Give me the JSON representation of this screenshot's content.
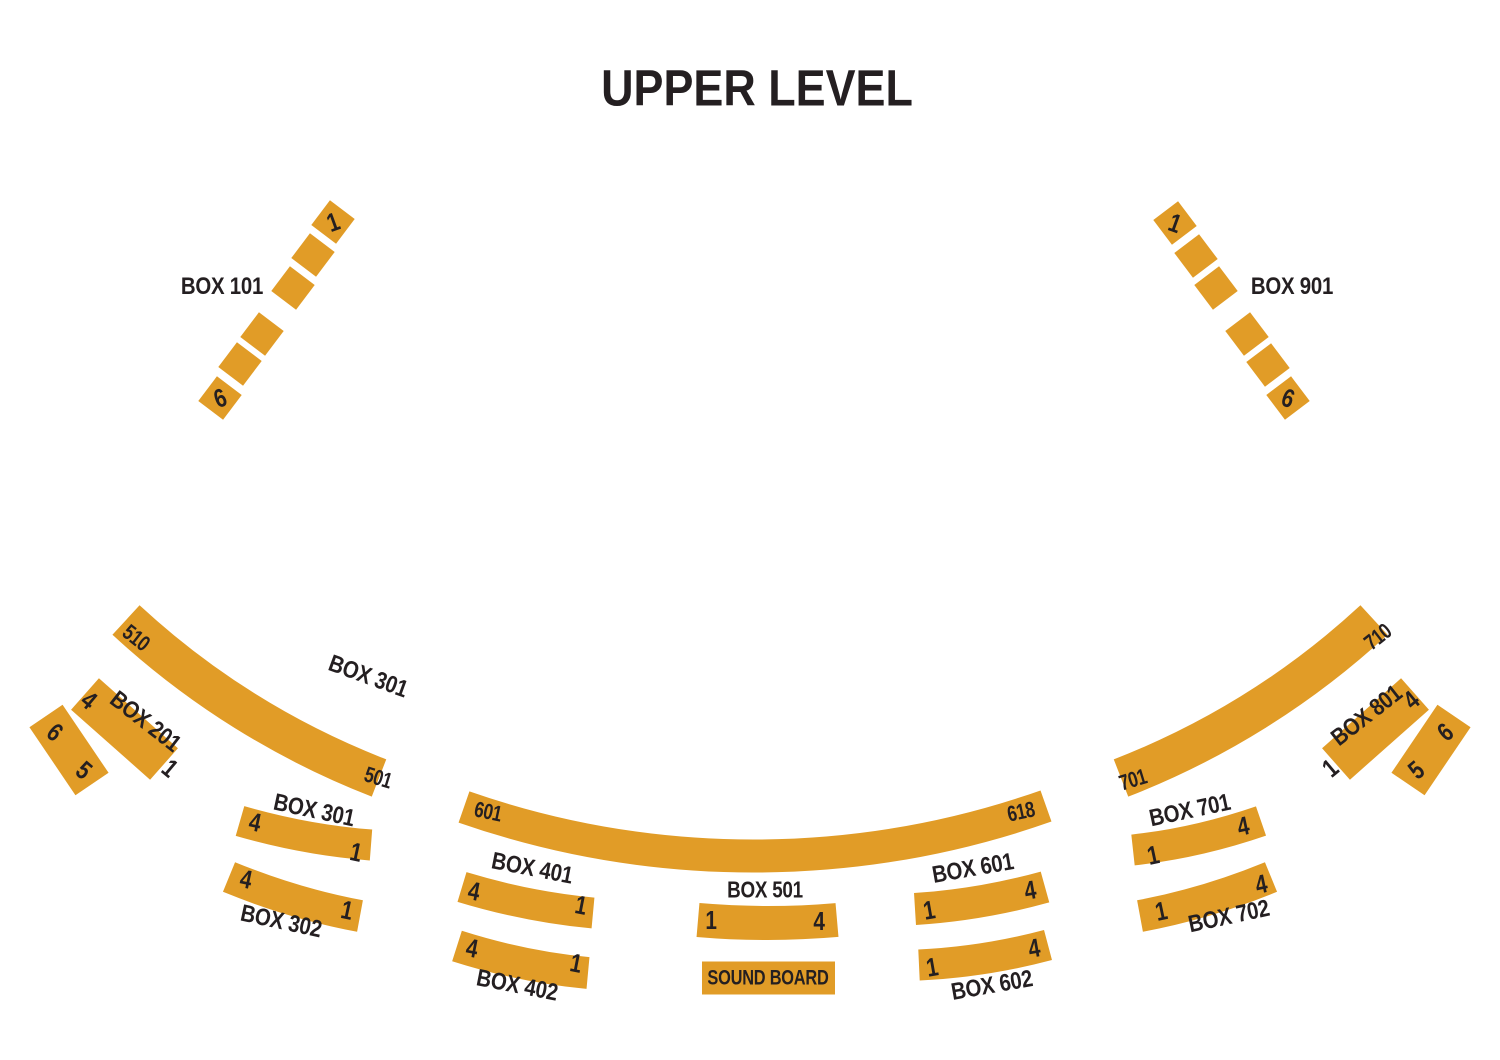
{
  "title": "UPPER LEVEL",
  "colors": {
    "seat_gold": "#E19C27",
    "text_ink": "#241F21",
    "background": "#FFFFFF"
  },
  "soundboard_label": "SOUND BOARD",
  "boxes": {
    "box101": {
      "label": "BOX 101",
      "seat_first": "1",
      "seat_last": "6"
    },
    "box901": {
      "label": "BOX 901",
      "seat_first": "1",
      "seat_last": "6"
    },
    "box201": {
      "label": "BOX 201",
      "seat1": "1",
      "seat4": "4",
      "seat5": "5",
      "seat6": "6"
    },
    "box801": {
      "label": "BOX 801",
      "seat1": "1",
      "seat4": "4",
      "seat5": "5",
      "seat6": "6"
    },
    "row500": {
      "label": "BOX 301",
      "seat_first": "501",
      "seat_last": "510"
    },
    "row600": {
      "seat_first": "601",
      "seat_last": "618"
    },
    "row700": {
      "seat_first": "701",
      "seat_last": "710"
    },
    "box301": {
      "label": "BOX 301",
      "seat1": "1",
      "seat4": "4"
    },
    "box302": {
      "label": "BOX 302",
      "seat1": "1",
      "seat4": "4"
    },
    "box401": {
      "label": "BOX 401",
      "seat1": "1",
      "seat4": "4"
    },
    "box402": {
      "label": "BOX 402",
      "seat1": "1",
      "seat4": "4"
    },
    "box501": {
      "label": "BOX 501",
      "seat1": "1",
      "seat4": "4"
    },
    "box601": {
      "label": "BOX 601",
      "seat1": "1",
      "seat4": "4"
    },
    "box602": {
      "label": "BOX 602",
      "seat1": "1",
      "seat4": "4"
    },
    "box701": {
      "label": "BOX 701",
      "seat1": "1",
      "seat4": "4"
    },
    "box702": {
      "label": "BOX 702",
      "seat1": "1",
      "seat4": "4"
    }
  }
}
